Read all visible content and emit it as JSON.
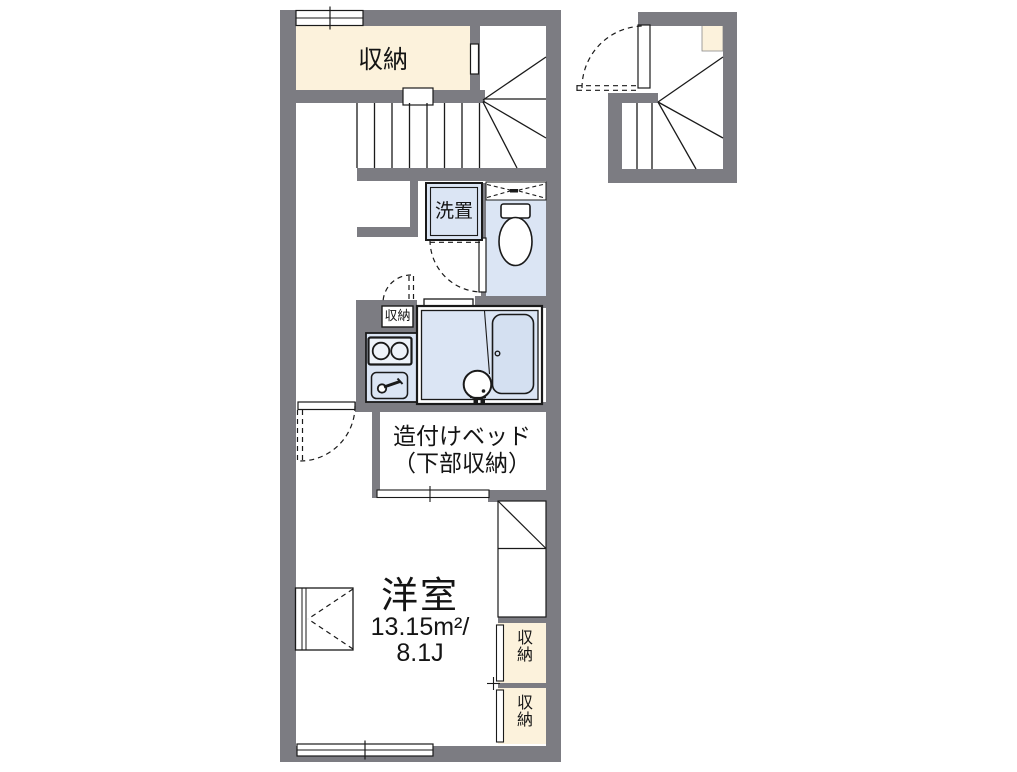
{
  "plan": {
    "title": "apartment-floor-plan",
    "labels": {
      "closet_top": "収納",
      "laundry": "洗置",
      "kitchen_closet": "収納",
      "bed_line1": "造付けベッド",
      "bed_line2": "（下部収納）",
      "room_name": "洋室",
      "room_area_sqm": "13.15m²/",
      "room_area_tatami": "8.1J",
      "closet_right_upper": "収納",
      "closet_right_lower": "収納"
    },
    "colors": {
      "wall": "#7c7c82",
      "closet_fill": "#fcf2dc",
      "wet_area_fill": "#dbe5f4",
      "tub_fill": "#d4e0f1",
      "line": "#1a1a1a"
    }
  }
}
